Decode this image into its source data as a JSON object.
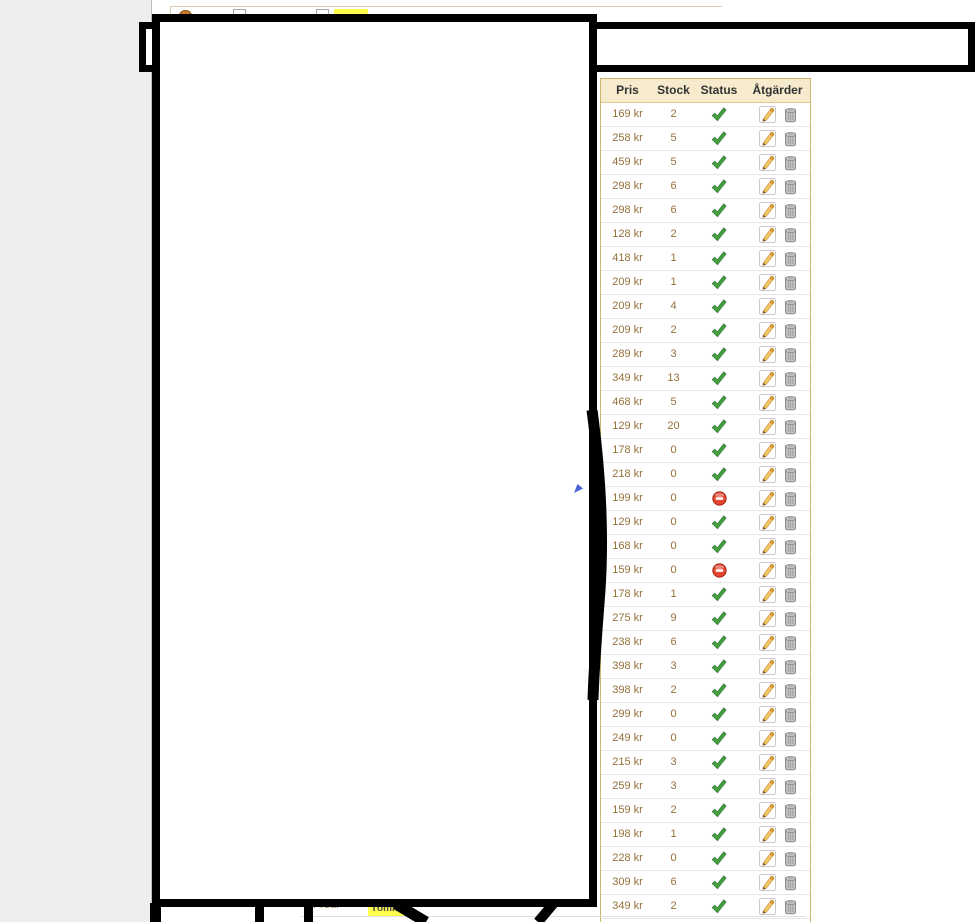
{
  "colors": {
    "page_background": "#FFFFFF",
    "left_strip": "#EEEEEE",
    "annotation_black": "#000000",
    "table_border": "#C9B76E",
    "header_background": "#F6EBCD",
    "header_text": "#333333",
    "cell_text_brown": "#95703D",
    "row_divider": "#E8E8E8",
    "status_enabled_green": "#44A340",
    "status_disabled_red": "#E4452F",
    "pencil_gold": "#F4C468",
    "trash_gray": "#C4C4C4",
    "highlight_yellow": "#FFFF4D"
  },
  "toolbar_fragment": {
    "icons": [
      "orange-blob-icon",
      "page-icon",
      "page-icon"
    ],
    "highlight": "yellow-highlight"
  },
  "table": {
    "headers": [
      "Pris",
      "Stock",
      "Status",
      "Åtgärder"
    ],
    "icons": {
      "enabled": "check-icon",
      "disabled": "disabled-icon",
      "edit": "pencil-icon",
      "delete": "trash-icon"
    },
    "rows": [
      {
        "price": "169 kr",
        "stock": "2",
        "status": "enabled"
      },
      {
        "price": "258 kr",
        "stock": "5",
        "status": "enabled"
      },
      {
        "price": "459 kr",
        "stock": "5",
        "status": "enabled"
      },
      {
        "price": "298 kr",
        "stock": "6",
        "status": "enabled"
      },
      {
        "price": "298 kr",
        "stock": "6",
        "status": "enabled"
      },
      {
        "price": "128 kr",
        "stock": "2",
        "status": "enabled"
      },
      {
        "price": "418 kr",
        "stock": "1",
        "status": "enabled"
      },
      {
        "price": "209 kr",
        "stock": "1",
        "status": "enabled"
      },
      {
        "price": "209 kr",
        "stock": "4",
        "status": "enabled"
      },
      {
        "price": "209 kr",
        "stock": "2",
        "status": "enabled"
      },
      {
        "price": "289 kr",
        "stock": "3",
        "status": "enabled"
      },
      {
        "price": "349 kr",
        "stock": "13",
        "status": "enabled"
      },
      {
        "price": "468 kr",
        "stock": "5",
        "status": "enabled"
      },
      {
        "price": "129 kr",
        "stock": "20",
        "status": "enabled"
      },
      {
        "price": "178 kr",
        "stock": "0",
        "status": "enabled"
      },
      {
        "price": "218 kr",
        "stock": "0",
        "status": "enabled"
      },
      {
        "price": "199 kr",
        "stock": "0",
        "status": "disabled"
      },
      {
        "price": "129 kr",
        "stock": "0",
        "status": "enabled"
      },
      {
        "price": "168 kr",
        "stock": "0",
        "status": "enabled"
      },
      {
        "price": "159 kr",
        "stock": "0",
        "status": "disabled"
      },
      {
        "price": "178 kr",
        "stock": "1",
        "status": "enabled"
      },
      {
        "price": "275 kr",
        "stock": "9",
        "status": "enabled"
      },
      {
        "price": "238 kr",
        "stock": "6",
        "status": "enabled"
      },
      {
        "price": "398 kr",
        "stock": "3",
        "status": "enabled"
      },
      {
        "price": "398 kr",
        "stock": "2",
        "status": "enabled"
      },
      {
        "price": "299 kr",
        "stock": "0",
        "status": "enabled"
      },
      {
        "price": "249 kr",
        "stock": "0",
        "status": "enabled"
      },
      {
        "price": "215 kr",
        "stock": "3",
        "status": "enabled"
      },
      {
        "price": "259 kr",
        "stock": "3",
        "status": "enabled"
      },
      {
        "price": "159 kr",
        "stock": "2",
        "status": "enabled"
      },
      {
        "price": "198 kr",
        "stock": "1",
        "status": "enabled"
      },
      {
        "price": "228 kr",
        "stock": "0",
        "status": "enabled"
      },
      {
        "price": "309 kr",
        "stock": "6",
        "status": "enabled"
      },
      {
        "price": "349 kr",
        "stock": "2",
        "status": "enabled"
      }
    ]
  },
  "bottom_fragments": {
    "text": "Prour",
    "highlight_text": "Tömnin"
  }
}
